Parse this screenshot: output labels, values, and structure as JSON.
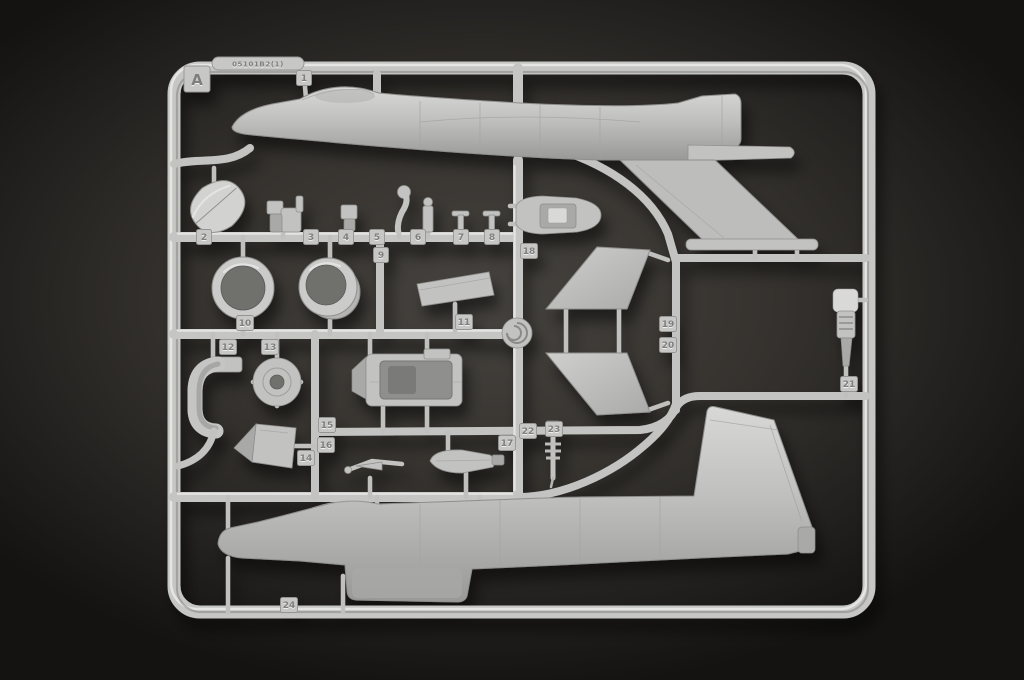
{
  "sprue": {
    "frame_letter": "A",
    "mold_code": "05101B2(1)",
    "part_tags": [
      "1",
      "2",
      "3",
      "4",
      "5",
      "6",
      "7",
      "8",
      "9",
      "10",
      "11",
      "12",
      "13",
      "14",
      "15",
      "16",
      "17",
      "18",
      "19",
      "20",
      "21",
      "22",
      "23",
      "24"
    ],
    "colors": {
      "plastic": "#c5c5c3",
      "plastic_highlight": "#eaeae8",
      "plastic_shadow": "#8b8b89",
      "background_center": "#46433f",
      "background_edge": "#141312",
      "tag_numeral": "#7e7e7c"
    }
  }
}
